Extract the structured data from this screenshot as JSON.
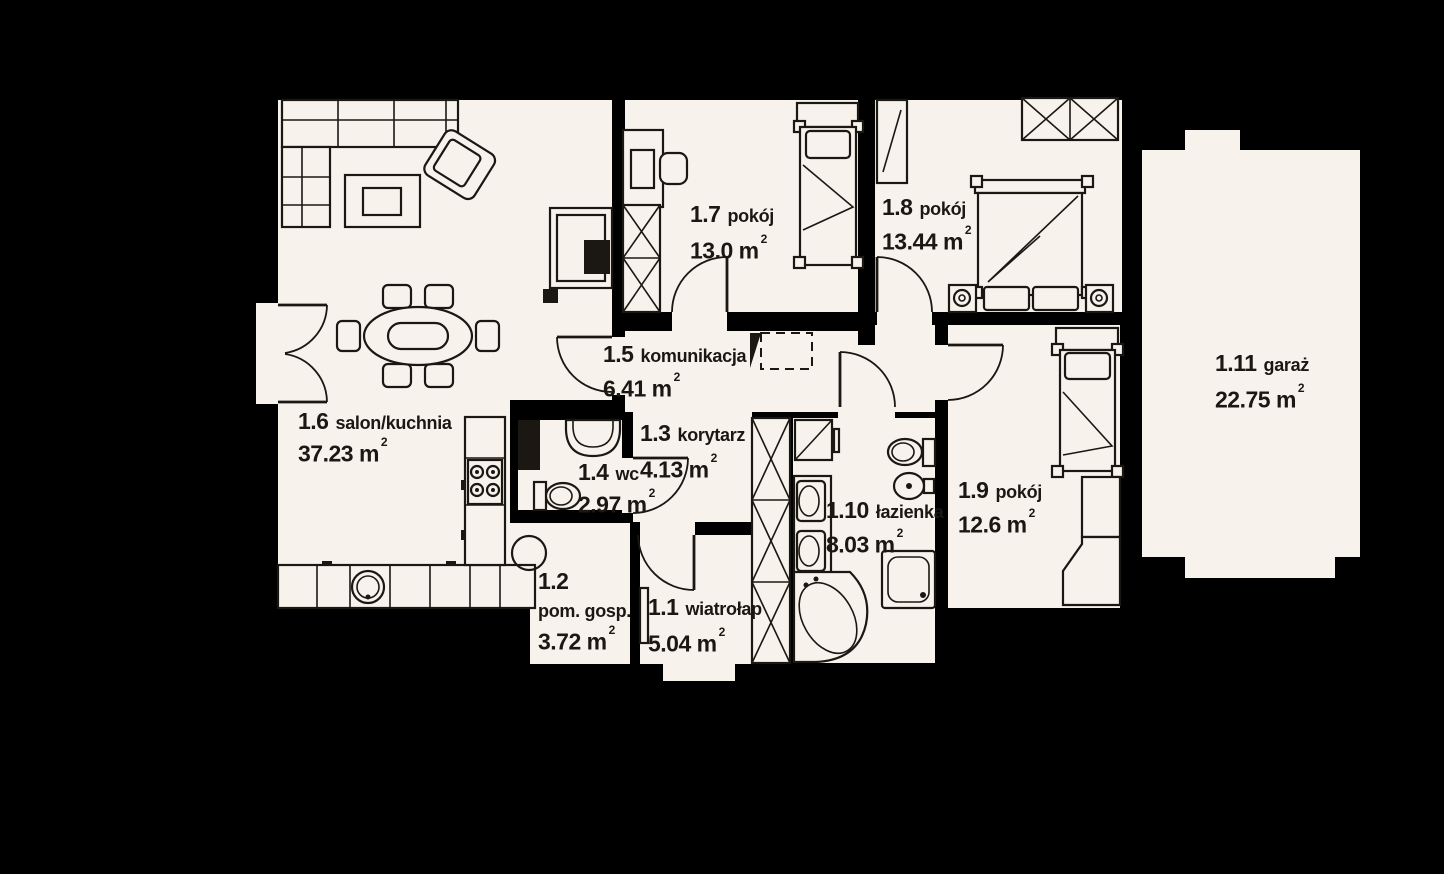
{
  "plan_title": "floor plan",
  "rooms": [
    {
      "number": "1.1",
      "name": "wiatrołap",
      "area": "5.04 m",
      "area_sup": "2"
    },
    {
      "number": "1.2",
      "name": "pom. gosp.",
      "area": "3.72 m",
      "area_sup": "2"
    },
    {
      "number": "1.3",
      "name": "korytarz",
      "area": "4.13 m",
      "area_sup": "2"
    },
    {
      "number": "1.4",
      "name": "wc",
      "area": "2.97 m",
      "area_sup": "2"
    },
    {
      "number": "1.5",
      "name": "komunikacja",
      "area": "6.41 m",
      "area_sup": "2"
    },
    {
      "number": "1.6",
      "name": "salon/kuchnia",
      "area": "37.23 m",
      "area_sup": "2"
    },
    {
      "number": "1.7",
      "name": "pokój",
      "area": "13.0 m",
      "area_sup": "2"
    },
    {
      "number": "1.8",
      "name": "pokój",
      "area": "13.44 m",
      "area_sup": "2"
    },
    {
      "number": "1.9",
      "name": "pokój",
      "area": "12.6 m",
      "area_sup": "2"
    },
    {
      "number": "1.10",
      "name": "łazienka",
      "area": "8.03 m",
      "area_sup": "2"
    },
    {
      "number": "1.11",
      "name": "garaż",
      "area": "22.75 m",
      "area_sup": "2"
    }
  ],
  "colors": {
    "background": "#000000",
    "floor": "#f7f2ec",
    "line": "#1b1712"
  }
}
